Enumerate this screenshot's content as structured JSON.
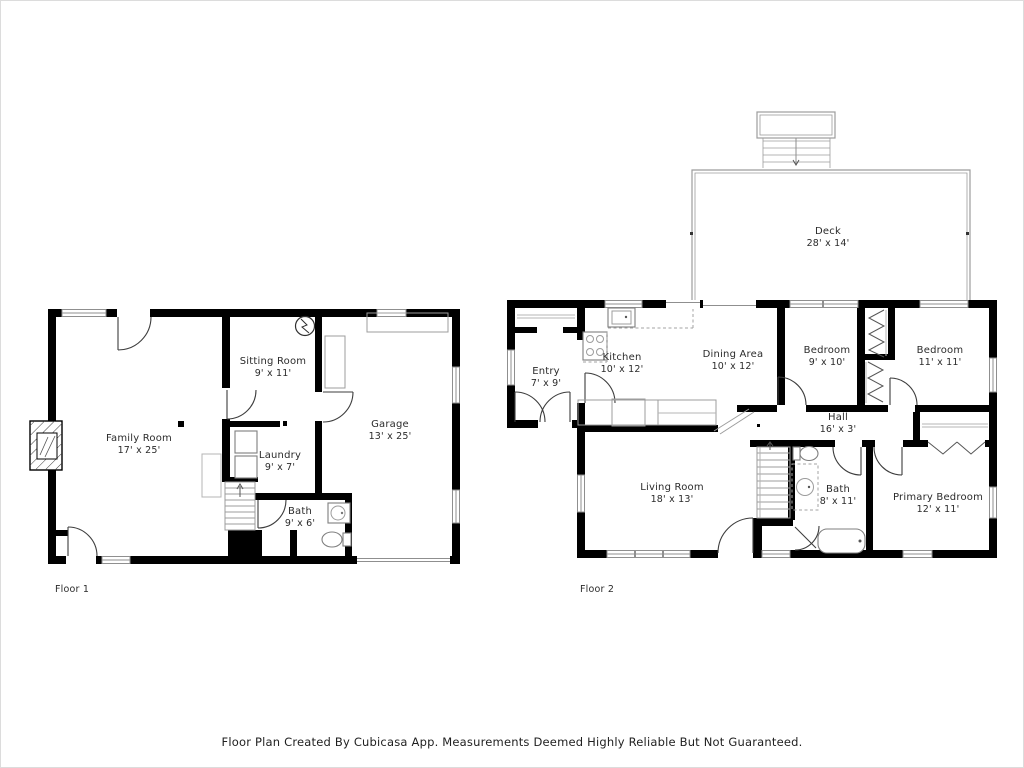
{
  "footer": {
    "disclaimer": "Floor Plan Created By Cubicasa App. Measurements Deemed Highly Reliable But Not Guaranteed."
  },
  "floor1": {
    "label": "Floor 1",
    "rooms": {
      "family": {
        "name": "Family Room",
        "dims": "17' x 25'"
      },
      "sitting": {
        "name": "Sitting Room",
        "dims": "9' x 11'"
      },
      "laundry": {
        "name": "Laundry",
        "dims": "9' x 7'"
      },
      "bath": {
        "name": "Bath",
        "dims": "9' x 6'"
      },
      "garage": {
        "name": "Garage",
        "dims": "13' x 25'"
      }
    }
  },
  "floor2": {
    "label": "Floor 2",
    "rooms": {
      "deck": {
        "name": "Deck",
        "dims": "28' x 14'"
      },
      "entry": {
        "name": "Entry",
        "dims": "7' x 9'"
      },
      "kitchen": {
        "name": "Kitchen",
        "dims": "10' x 12'"
      },
      "dining": {
        "name": "Dining Area",
        "dims": "10' x 12'"
      },
      "bedroom1": {
        "name": "Bedroom",
        "dims": "9' x 10'"
      },
      "bedroom2": {
        "name": "Bedroom",
        "dims": "11' x 11'"
      },
      "hall": {
        "name": "Hall",
        "dims": "16' x 3'"
      },
      "living": {
        "name": "Living Room",
        "dims": "18' x 13'"
      },
      "bath": {
        "name": "Bath",
        "dims": "8' x 11'"
      },
      "primary": {
        "name": "Primary Bedroom",
        "dims": "12' x 11'"
      }
    }
  },
  "colors": {
    "background": "#ffffff",
    "wall": "#000000",
    "fixture_line": "#8f8f8f",
    "light_line": "#b4b4b4",
    "text": "#2b2b2b"
  }
}
